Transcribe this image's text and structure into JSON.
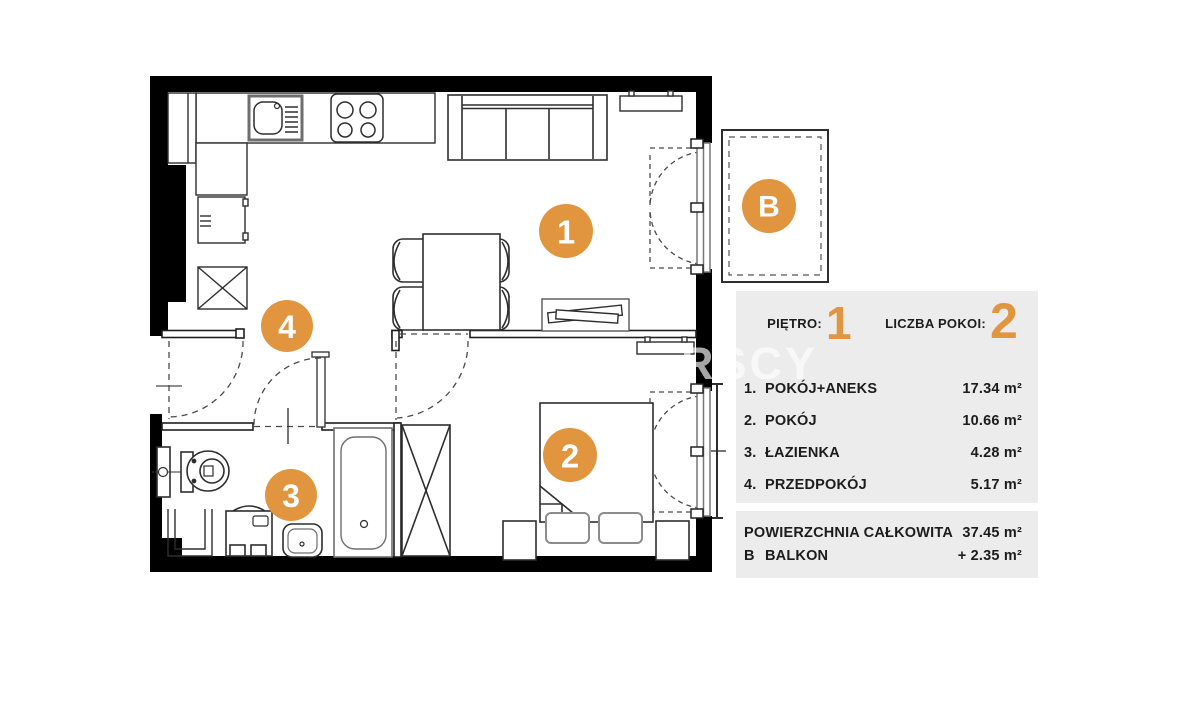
{
  "plan": {
    "watermark": "RSCY",
    "labels": [
      {
        "id": "room-1",
        "text": "1"
      },
      {
        "id": "room-2",
        "text": "2"
      },
      {
        "id": "room-3",
        "text": "3"
      },
      {
        "id": "room-4",
        "text": "4"
      },
      {
        "id": "balcony",
        "text": "B"
      }
    ]
  },
  "panel": {
    "floor_label": "PIĘTRO:",
    "floor_value": "1",
    "rooms_count_label": "LICZBA POKOI:",
    "rooms_count_value": "2",
    "rooms": [
      {
        "index": "1.",
        "name": "POKÓJ+ANEKS",
        "area": "17.34 m²"
      },
      {
        "index": "2.",
        "name": "POKÓJ",
        "area": "10.66 m²"
      },
      {
        "index": "3.",
        "name": "ŁAZIENKA",
        "area": "4.28 m²"
      },
      {
        "index": "4.",
        "name": "PRZEDPOKÓJ",
        "area": "5.17 m²"
      }
    ],
    "total_label": "POWIERZCHNIA CAŁKOWITA",
    "total_area": "37.45 m²",
    "balcony_index": "B",
    "balcony_label": "BALKON",
    "balcony_area": "+ 2.35 m²"
  },
  "colors": {
    "accent": "#E0953E",
    "panel_bg": "#ECECEC",
    "wall": "#000000"
  }
}
